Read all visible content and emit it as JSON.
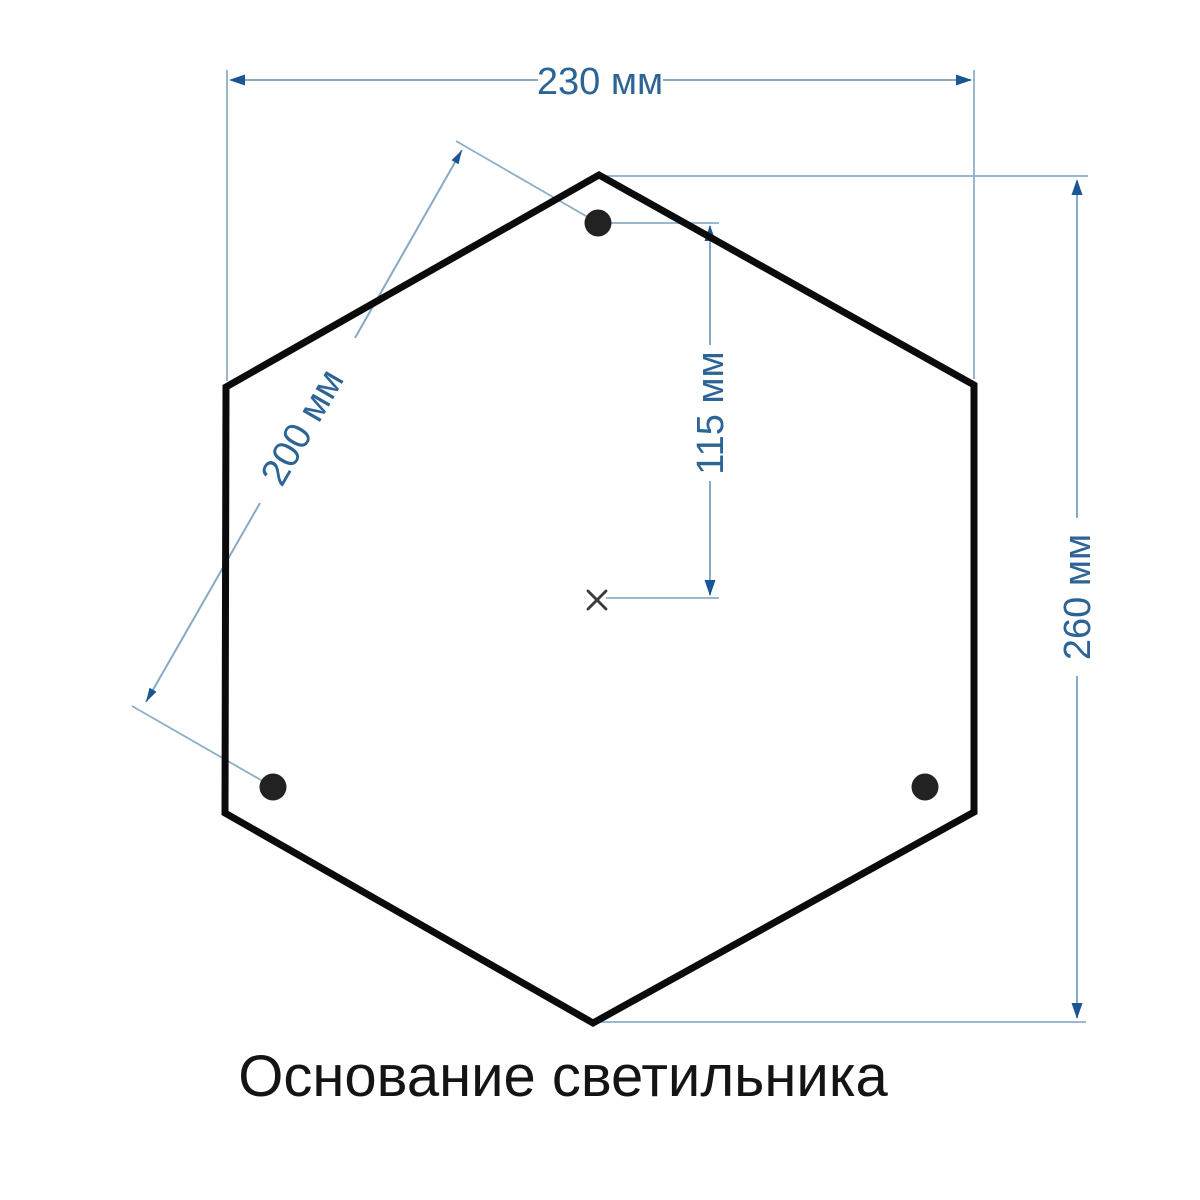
{
  "caption": {
    "text": "Основание светильника",
    "color": "#141414"
  },
  "dimensions": {
    "width_top": {
      "label": "230 мм",
      "value": 230,
      "unit": "мм"
    },
    "hole_spacing_diagonal": {
      "label": "200 мм",
      "value": 200,
      "unit": "мм"
    },
    "hole_to_center_vertical": {
      "label": "115 мм",
      "value": 115,
      "unit": "мм"
    },
    "height_right": {
      "label": "260 мм",
      "value": 260,
      "unit": "мм"
    }
  },
  "drawing": {
    "mounting_holes_count": 3,
    "colors": {
      "outline": "#0b0b0b",
      "hole_fill": "#222222",
      "dimension_line": "#8caec7",
      "arrowhead": "#1b5593",
      "dimension_text": "#2c6496",
      "caption_text": "#141414",
      "background": "#ffffff"
    }
  }
}
